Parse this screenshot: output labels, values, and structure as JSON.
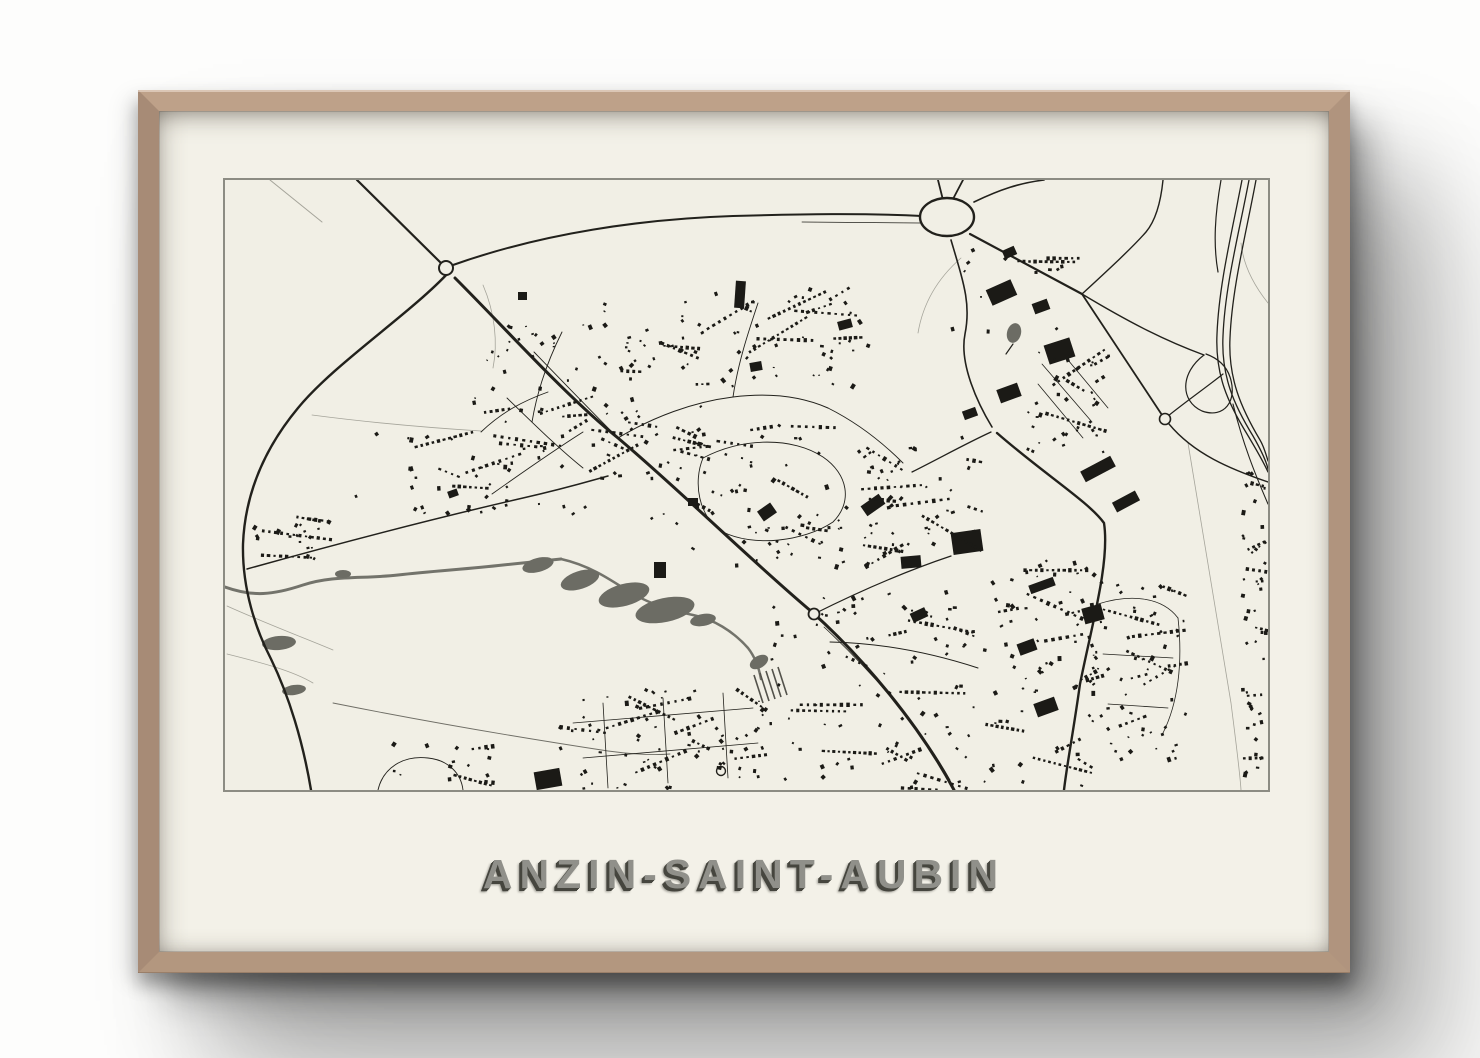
{
  "poster": {
    "title": "ANZIN-SAINT-AUBIN"
  },
  "map": {
    "viewbox": "223 178 1043 610",
    "colors": {
      "bg": "#f1efe5",
      "road": "#22211c",
      "minor": "#3a3933",
      "boundary": "#a5a49a",
      "water": "#73736b",
      "water_dark": "#6c6c64",
      "building": "#1b1a16",
      "border": "#8c8c83"
    },
    "roads": [
      {
        "id": "faint-topleft",
        "d": "M268,178 L320,220",
        "w": 1,
        "c": "#a5a49a"
      },
      {
        "id": "bnd-1",
        "d": "M310,413 C371,421 431,426 479,429",
        "w": 0.8,
        "c": "#a5a49a"
      },
      {
        "id": "bnd-2",
        "d": "M481,283 C493,311 496,341 491,366",
        "w": 0.8,
        "c": "#a5a49a"
      },
      {
        "id": "bnd-3",
        "d": "M1186,441 C1201,531 1216,621 1229,701 C1234,741 1238,771 1239,788",
        "w": 0.8,
        "c": "#a5a49a"
      },
      {
        "id": "bnd-4",
        "d": "M1266,301 C1250,281 1241,261 1239,241",
        "w": 0.8,
        "c": "#a5a49a"
      },
      {
        "id": "bnd-5",
        "d": "M959,256 C936,276 921,301 916,331",
        "w": 0.8,
        "c": "#a5a49a"
      },
      {
        "id": "bnd-6",
        "d": "M225,652 C261,661 291,669 311,681",
        "w": 0.8,
        "c": "#a5a49a"
      },
      {
        "id": "bnd-7",
        "d": "M225,604 C265,622 305,637 331,648",
        "w": 0.8,
        "c": "#a5a49a"
      },
      {
        "id": "riverside",
        "d": "M331,701 C421,719 521,736 606,749 C636,753 656,753 668,752",
        "w": 0.9,
        "c": "#6f6e66"
      },
      {
        "id": "nw-approach",
        "d": "M355,178 L440,262",
        "w": 2.2
      },
      {
        "id": "west-curve",
        "d": "M447,270 C408,312 332,362 296,406 C262,447 243,492 241,542 C240,587 254,628 269,657 C287,694 301,740 309,788",
        "w": 2.4
      },
      {
        "id": "ring-sweep",
        "d": "M451,263 C541,231 641,217 731,214 C801,212 861,211 920,214",
        "w": 2
      },
      {
        "id": "ring-dual",
        "d": "M800,220 L918,221",
        "w": 0.8
      },
      {
        "id": "main-spine",
        "d": "M453,276 C505,328 562,392 616,436 C681,491 746,556 810,610 C860,655 917,722 952,788",
        "w": 3
      },
      {
        "id": "spine-parallel",
        "d": "M822,625 C868,668 918,724 948,778",
        "w": 0.8
      },
      {
        "id": "rb-stub-n1",
        "d": "M936,178 L941,198",
        "w": 1.8
      },
      {
        "id": "rb-stub-n2",
        "d": "M961,178 L951,197",
        "w": 1.8
      },
      {
        "id": "rb-ne",
        "d": "M972,200 C999,187 1018,181 1042,178",
        "w": 1.6
      },
      {
        "id": "rb-se",
        "d": "M968,232 L1080,292",
        "w": 2.2
      },
      {
        "id": "junction-n",
        "d": "M1080,292 C1106,268 1130,246 1144,230 C1154,218 1159,198 1161,178",
        "w": 1.4
      },
      {
        "id": "straight-se",
        "d": "M1080,292 L1160,413",
        "w": 1.8
      },
      {
        "id": "node-se-merge",
        "d": "M1167,422 C1192,452 1228,467 1266,480",
        "w": 1.4
      },
      {
        "id": "industrial-s",
        "d": "M949,238 C962,282 969,302 963,332 C957,362 976,402 990,425",
        "w": 1.6
      },
      {
        "id": "node-west",
        "d": "M989,430 C963,442 938,456 910,470",
        "w": 1.3
      },
      {
        "id": "rail-ssw",
        "d": "M995,431 C1042,472 1087,500 1102,521 C1108,560 1090,622 1078,682 C1071,732 1065,762 1062,788",
        "w": 2.4
      },
      {
        "id": "hwy-1",
        "d": "M1240,178 C1230,230 1217,282 1215,332 C1213,373 1226,401 1245,432 C1254,447 1261,459 1266,470",
        "w": 1.3
      },
      {
        "id": "hwy-2",
        "d": "M1247,178 C1237,231 1223,284 1221,334 C1219,374 1232,403 1251,434 C1259,448 1264,458 1266,467",
        "w": 1.3
      },
      {
        "id": "hwy-3",
        "d": "M1254,178 C1244,232 1230,286 1228,336 C1226,376 1239,406 1258,438 C1261,443 1264,452 1266,459",
        "w": 1.3
      },
      {
        "id": "hwy-s-branch",
        "d": "M1231,402 C1241,442 1253,472 1266,502",
        "w": 1.1
      },
      {
        "id": "hwy-top-single",
        "d": "M1219,178 C1213,212 1211,242 1216,270",
        "w": 1.2
      },
      {
        "id": "ramp-ne",
        "d": "M1080,292 C1130,322 1164,339 1202,353",
        "w": 1.4
      },
      {
        "id": "ramp-loop",
        "d": "M1202,353 C1178,371 1178,399 1200,409 C1222,417 1236,399 1228,375 C1224,363 1215,356 1204,352",
        "w": 1.2
      },
      {
        "id": "ramp-node",
        "d": "M1166,414 C1186,398 1206,384 1221,372",
        "w": 1.2
      },
      {
        "id": "hamlet-road",
        "d": "M245,567 C331,543 421,519 521,496 C561,487 581,481 606,474",
        "w": 1.5
      },
      {
        "id": "town-ne-street",
        "d": "M812,612 C858,589 904,569 949,554",
        "w": 1.2
      },
      {
        "id": "town-e-street",
        "d": "M828,640 C880,641 930,651 976,666",
        "w": 1
      },
      {
        "id": "st-nw-1",
        "d": "M490,492 C521,470 551,449 581,430",
        "w": 0.9
      },
      {
        "id": "st-nw-2",
        "d": "M505,396 C531,421 556,446 581,466",
        "w": 0.9
      },
      {
        "id": "st-nw-3",
        "d": "M532,350 C562,381 591,411 616,436",
        "w": 0.9
      },
      {
        "id": "st-nw-4",
        "d": "M479,430 C500,410 521,399 546,390",
        "w": 0.9
      },
      {
        "id": "st-nw-5",
        "d": "M560,330 C545,360 535,390 530,420",
        "w": 0.9
      },
      {
        "id": "st-c-1",
        "d": "M616,436 C651,415 691,400 731,395 C771,390 801,395 826,406",
        "w": 1
      },
      {
        "id": "st-c-loop",
        "d": "M701,456 C741,435 791,435 821,455 C846,472 851,500 831,520 C801,540 751,545 721,530 C696,515 691,480 701,456",
        "w": 0.9
      },
      {
        "id": "st-c-2",
        "d": "M826,406 C856,421 881,441 901,461",
        "w": 0.9
      },
      {
        "id": "st-c-3",
        "d": "M731,395 C736,361 746,331 756,301",
        "w": 0.9
      },
      {
        "id": "st-e-1",
        "d": "M1040,362 L1090,420",
        "w": 0.8
      },
      {
        "id": "st-e-2",
        "d": "M1061,352 L1106,406",
        "w": 0.8
      },
      {
        "id": "st-e-3",
        "d": "M1036,382 L1081,436",
        "w": 0.8
      },
      {
        "id": "st-r-1",
        "d": "M1096,602 C1131,591 1161,596 1176,616",
        "w": 0.8
      },
      {
        "id": "st-r-2",
        "d": "M1101,652 L1171,656",
        "w": 0.8
      },
      {
        "id": "st-r-3",
        "d": "M1106,702 L1166,706",
        "w": 0.8
      },
      {
        "id": "st-r-4",
        "d": "M1176,616 C1181,661 1176,701 1161,731",
        "w": 0.8
      },
      {
        "id": "st-b-1",
        "d": "M571,721 L751,706",
        "w": 0.8
      },
      {
        "id": "st-b-2",
        "d": "M581,756 L756,741",
        "w": 0.8
      },
      {
        "id": "st-b-3",
        "d": "M601,701 L606,786",
        "w": 0.8
      },
      {
        "id": "st-b-4",
        "d": "M661,696 L666,781",
        "w": 0.8
      },
      {
        "id": "st-b-5",
        "d": "M721,691 L726,776",
        "w": 0.8
      },
      {
        "id": "lane-bl",
        "d": "M376,788 C381,766 401,753 426,756 C446,758 459,771 461,788",
        "w": 0.9
      },
      {
        "id": "cul-stem",
        "d": "M1004,352 L1011,342",
        "w": 1.2
      }
    ],
    "rivers": [
      {
        "d": "M223,585 C251,595 271,593 301,583 C331,573 361,577 396,573 C431,569 466,567 501,563 C521,561 541,559 559,557",
        "w": 3
      },
      {
        "d": "M559,557 C586,563 606,576 626,589 C646,601 666,608 691,613 C711,617 731,629 746,646 C753,655 757,666 759,677",
        "w": 2.5
      }
    ],
    "ponds": [
      {
        "cx": 536,
        "cy": 563,
        "rx": 16,
        "ry": 7,
        "rot": -15
      },
      {
        "cx": 578,
        "cy": 578,
        "rx": 20,
        "ry": 9,
        "rot": -18
      },
      {
        "cx": 622,
        "cy": 593,
        "rx": 26,
        "ry": 11,
        "rot": -15
      },
      {
        "cx": 663,
        "cy": 608,
        "rx": 30,
        "ry": 12,
        "rot": -12
      },
      {
        "cx": 701,
        "cy": 618,
        "rx": 13,
        "ry": 6,
        "rot": -10
      },
      {
        "cx": 277,
        "cy": 641,
        "rx": 17,
        "ry": 7,
        "rot": -5
      },
      {
        "cx": 292,
        "cy": 688,
        "rx": 12,
        "ry": 5,
        "rot": -8
      },
      {
        "cx": 341,
        "cy": 572,
        "rx": 8,
        "ry": 4,
        "rot": 0
      },
      {
        "cx": 757,
        "cy": 660,
        "rx": 10,
        "ry": 6,
        "rot": -30
      },
      {
        "cx": 1012,
        "cy": 331,
        "rx": 7,
        "ry": 10,
        "rot": 15
      }
    ],
    "roundabouts": [
      {
        "cx": 945,
        "cy": 215,
        "rx": 27,
        "ry": 19,
        "w": 2.4
      },
      {
        "cx": 444,
        "cy": 266,
        "rx": 7,
        "ry": 7,
        "w": 2
      },
      {
        "cx": 812,
        "cy": 612,
        "rx": 5.5,
        "ry": 5.5,
        "w": 1.8
      },
      {
        "cx": 1163,
        "cy": 417,
        "rx": 5.5,
        "ry": 5.5,
        "w": 1.6
      },
      {
        "cx": 719,
        "cy": 769,
        "rx": 4.5,
        "ry": 4.5,
        "w": 1.4
      }
    ],
    "hatch": {
      "c": "#53524b",
      "w": 1.6,
      "lines": [
        "M752,673 L761,701",
        "M758,671 L767,699",
        "M764,669 L773,697",
        "M770,667 L779,695",
        "M776,665 L785,693"
      ]
    },
    "blocks": [
      {
        "x": 733,
        "y": 279,
        "w": 10,
        "h": 27,
        "r": 4
      },
      {
        "x": 516,
        "y": 290,
        "w": 9,
        "h": 8,
        "r": 0
      },
      {
        "x": 986,
        "y": 282,
        "w": 27,
        "h": 17,
        "r": -24
      },
      {
        "x": 1001,
        "y": 246,
        "w": 13,
        "h": 9,
        "r": -24
      },
      {
        "x": 1031,
        "y": 299,
        "w": 16,
        "h": 11,
        "r": -20
      },
      {
        "x": 1044,
        "y": 339,
        "w": 27,
        "h": 20,
        "r": -18
      },
      {
        "x": 996,
        "y": 384,
        "w": 22,
        "h": 14,
        "r": -20
      },
      {
        "x": 961,
        "y": 407,
        "w": 14,
        "h": 9,
        "r": -20
      },
      {
        "x": 1079,
        "y": 461,
        "w": 34,
        "h": 12,
        "r": -28
      },
      {
        "x": 1111,
        "y": 494,
        "w": 26,
        "h": 11,
        "r": -28
      },
      {
        "x": 950,
        "y": 529,
        "w": 30,
        "h": 22,
        "r": -8
      },
      {
        "x": 899,
        "y": 554,
        "w": 20,
        "h": 12,
        "r": -5
      },
      {
        "x": 1027,
        "y": 579,
        "w": 26,
        "h": 9,
        "r": -20
      },
      {
        "x": 1081,
        "y": 604,
        "w": 20,
        "h": 16,
        "r": -15
      },
      {
        "x": 757,
        "y": 504,
        "w": 16,
        "h": 12,
        "r": -35
      },
      {
        "x": 686,
        "y": 496,
        "w": 10,
        "h": 8,
        "r": 0
      },
      {
        "x": 533,
        "y": 768,
        "w": 26,
        "h": 18,
        "r": -10
      },
      {
        "x": 909,
        "y": 608,
        "w": 16,
        "h": 10,
        "r": -25
      },
      {
        "x": 1016,
        "y": 639,
        "w": 18,
        "h": 12,
        "r": -20
      },
      {
        "x": 1033,
        "y": 698,
        "w": 22,
        "h": 14,
        "r": -20
      },
      {
        "x": 860,
        "y": 497,
        "w": 22,
        "h": 12,
        "r": -35
      },
      {
        "x": 836,
        "y": 318,
        "w": 14,
        "h": 9,
        "r": -15
      },
      {
        "x": 748,
        "y": 360,
        "w": 12,
        "h": 9,
        "r": -10
      },
      {
        "x": 652,
        "y": 560,
        "w": 12,
        "h": 16,
        "r": 0
      },
      {
        "x": 446,
        "y": 488,
        "w": 10,
        "h": 7,
        "r": -20
      }
    ],
    "clusters": [
      {
        "x": 468,
        "y": 322,
        "w": 240,
        "h": 200,
        "n": 90,
        "rows": 15,
        "seed": 11
      },
      {
        "x": 700,
        "y": 286,
        "w": 170,
        "h": 102,
        "n": 42,
        "rows": 8,
        "seed": 22
      },
      {
        "x": 690,
        "y": 415,
        "w": 210,
        "h": 150,
        "n": 70,
        "rows": 11,
        "seed": 33
      },
      {
        "x": 1025,
        "y": 345,
        "w": 82,
        "h": 105,
        "n": 32,
        "rows": 6,
        "seed": 44
      },
      {
        "x": 982,
        "y": 555,
        "w": 112,
        "h": 230,
        "n": 58,
        "rows": 10,
        "seed": 55
      },
      {
        "x": 1085,
        "y": 580,
        "w": 100,
        "h": 178,
        "n": 58,
        "rows": 10,
        "seed": 66
      },
      {
        "x": 1239,
        "y": 468,
        "w": 26,
        "h": 318,
        "n": 42,
        "rows": 9,
        "seed": 77
      },
      {
        "x": 556,
        "y": 688,
        "w": 212,
        "h": 100,
        "n": 62,
        "rows": 11,
        "seed": 88
      },
      {
        "x": 768,
        "y": 588,
        "w": 205,
        "h": 200,
        "n": 78,
        "rows": 13,
        "seed": 99
      },
      {
        "x": 248,
        "y": 515,
        "w": 92,
        "h": 50,
        "n": 18,
        "rows": 4,
        "seed": 101
      },
      {
        "x": 338,
        "y": 428,
        "w": 185,
        "h": 84,
        "n": 24,
        "rows": 5,
        "seed": 112
      },
      {
        "x": 928,
        "y": 240,
        "w": 150,
        "h": 92,
        "n": 12,
        "rows": 2,
        "seed": 123
      },
      {
        "x": 388,
        "y": 742,
        "w": 104,
        "h": 46,
        "n": 12,
        "rows": 3,
        "seed": 134
      },
      {
        "x": 600,
        "y": 300,
        "w": 100,
        "h": 70,
        "n": 16,
        "rows": 3,
        "seed": 145
      },
      {
        "x": 860,
        "y": 430,
        "w": 120,
        "h": 120,
        "n": 30,
        "rows": 5,
        "seed": 156
      }
    ]
  }
}
